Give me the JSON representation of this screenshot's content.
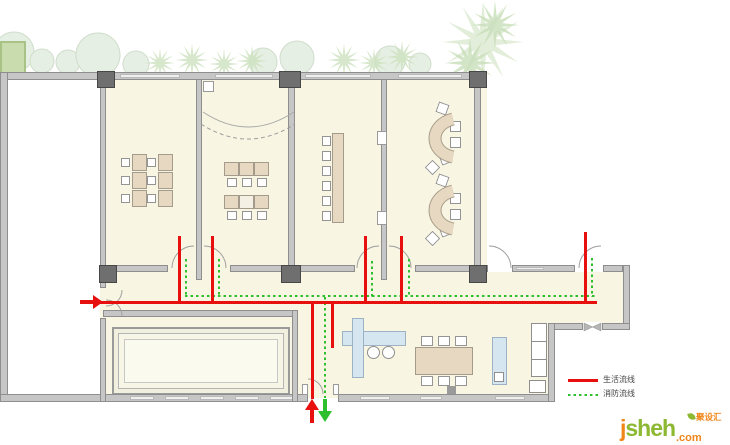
{
  "legend": {
    "items": [
      {
        "label": "生活流线",
        "style": "solid",
        "color": "#e80f0f"
      },
      {
        "label": "消防流线",
        "style": "dotted",
        "color": "#2ebf2e"
      }
    ]
  },
  "logo": {
    "prefix": "j",
    "word": "sheh",
    "suffix": ".com",
    "cn_label": "聚设汇",
    "green": "#8cb832",
    "orange": "#f08519"
  },
  "flows": {
    "life_route_color": "#e80f0f",
    "fire_route_color": "#2ebf2e",
    "arrows": [
      {
        "icon": "entry-arrow-right-icon",
        "color": "#e80f0f"
      },
      {
        "icon": "exit-arrow-up-icon",
        "color": "#e80f0f"
      },
      {
        "icon": "exit-arrow-down-icon",
        "color": "#2ebf2e"
      }
    ]
  },
  "plan": {
    "rooms": [
      {
        "name": "classroom-1",
        "furniture": "2 columns x 3 desks with side chairs"
      },
      {
        "name": "classroom-2",
        "furniture": "2 rows of 3 tables with chairs, curved curtain line"
      },
      {
        "name": "classroom-3",
        "furniture": "long vertical table with 6 chairs"
      },
      {
        "name": "classroom-4",
        "furniture": "2 arc-shaped desk clusters with chairs"
      },
      {
        "name": "pool-room",
        "furniture": "recessed pool / stage with stepped border"
      },
      {
        "name": "dining-room",
        "furniture": "cross table with 2 stools, 6-chair dining table, counter, cabinet"
      }
    ],
    "colors": {
      "floor": "#f8f6e2",
      "wall": "#c6c6c6",
      "column": "#6f6f6f",
      "desk": "#e7d8c1",
      "plants": "#cfe3c2"
    }
  }
}
